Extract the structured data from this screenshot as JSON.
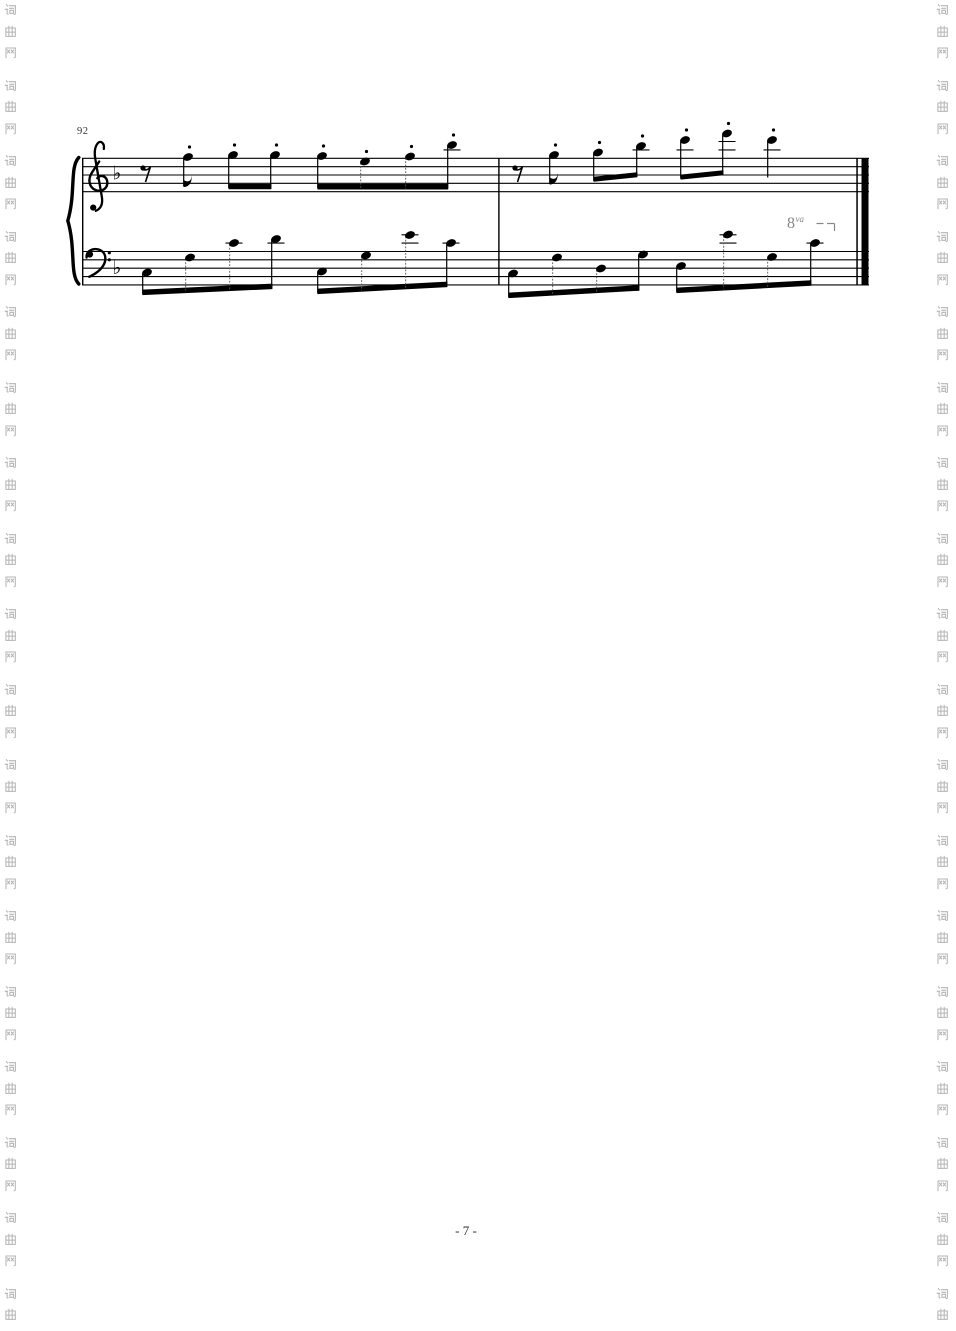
{
  "page": {
    "width": 956,
    "height": 1331,
    "background": "#ffffff",
    "page_number": "- 7 -",
    "page_number_color": "#2b2b2b"
  },
  "watermark": {
    "text": "词曲网",
    "chars": [
      "词",
      "曲",
      "网"
    ],
    "color": "#b5b5b5",
    "dash_color": "#c9c9c9",
    "columns": [
      {
        "side": "left",
        "char_x": 4,
        "line_x": 26
      },
      {
        "side": "right",
        "char_x": 936,
        "line_x": 930
      }
    ],
    "start_y": 3,
    "char_step": 21.5,
    "group_step": 75.5,
    "char_size": 13
  },
  "score": {
    "measure_number": "92",
    "measure_number_color": "#333333",
    "ink": "#000000",
    "geometry": {
      "x_start": 82,
      "x_end": 869,
      "treble_top": 158.3,
      "bass_top": 251.5,
      "gap": 8.35,
      "staff_line_count": 5,
      "system_top": 158.3,
      "system_bottom": 284.9
    },
    "brace": true,
    "clefs": [
      "treble",
      "bass"
    ],
    "key_signature": {
      "name": "1 flat (F major)",
      "glyph": "♭",
      "treble": {
        "x": 112.5,
        "baseline": 179.5
      },
      "bass": {
        "x": 112.5,
        "baseline": 274
      }
    },
    "rests": [
      {
        "type": "eighth",
        "staff": "treble",
        "x": 146,
        "y": 166
      },
      {
        "type": "eighth",
        "staff": "treble",
        "x": 518,
        "y": 166
      }
    ],
    "beams": [
      {
        "x1": 228.6,
        "y1": 184.0,
        "x2": 271.4,
        "y2": 184.0,
        "t": 5.2
      },
      {
        "x1": 317.6,
        "y1": 184.0,
        "x2": 448.2,
        "y2": 184.0,
        "t": 5.5
      },
      {
        "x1": 593.6,
        "y1": 176.8,
        "x2": 637.4,
        "y2": 172.2,
        "t": 5.0
      },
      {
        "x1": 680.6,
        "y1": 174.6,
        "x2": 723.4,
        "y2": 170.2,
        "t": 5.0
      },
      {
        "x1": 142.4,
        "y1": 289.6,
        "x2": 272.4,
        "y2": 283.6,
        "t": 5.5
      },
      {
        "x1": 317.4,
        "y1": 288.6,
        "x2": 447.4,
        "y2": 281.6,
        "t": 5.5
      },
      {
        "x1": 508.4,
        "y1": 292.6,
        "x2": 639.4,
        "y2": 285.2,
        "t": 5.5
      },
      {
        "x1": 676.4,
        "y1": 287.6,
        "x2": 811.4,
        "y2": 280.2,
        "t": 5.5
      }
    ],
    "notes": {
      "treble": [
        {
          "x": 188,
          "y": 157,
          "staccato": true,
          "flag": true,
          "stem_to": 186.5
        },
        {
          "x": 233,
          "y": 155,
          "staccato": true,
          "beam": 0
        },
        {
          "x": 275,
          "y": 155,
          "staccato": true,
          "beam": 0
        },
        {
          "x": 322,
          "y": 156,
          "staccato": true,
          "beam": 1
        },
        {
          "x": 365,
          "y": 161.5,
          "staccato": true,
          "beam": 1
        },
        {
          "x": 410,
          "y": 156.5,
          "staccato": true,
          "beam": 1
        },
        {
          "x": 452,
          "y": 145,
          "staccato": true,
          "beam": 1
        },
        {
          "x": 554,
          "y": 155,
          "staccato": true,
          "flag": true,
          "stem_to": 184
        },
        {
          "x": 598,
          "y": 152.5,
          "staccato": true,
          "beam": 2
        },
        {
          "x": 641,
          "y": 146,
          "staccato": true,
          "beam": 2
        },
        {
          "x": 685,
          "y": 140,
          "staccato": true,
          "beam": 3
        },
        {
          "x": 727,
          "y": 133.5,
          "staccato": true,
          "beam": 3
        },
        {
          "x": 772,
          "y": 140,
          "staccato": true,
          "stem_to": 177.5
        }
      ],
      "bass": [
        {
          "x": 147,
          "y": 272.5,
          "beam": 4
        },
        {
          "x": 190,
          "y": 257.5,
          "beam": 4
        },
        {
          "x": 234,
          "y": 243,
          "beam": 4
        },
        {
          "x": 276,
          "y": 239,
          "beam": 4
        },
        {
          "x": 322,
          "y": 271.5,
          "beam": 5
        },
        {
          "x": 366,
          "y": 255.5,
          "beam": 5
        },
        {
          "x": 410,
          "y": 235,
          "beam": 5
        },
        {
          "x": 451,
          "y": 243,
          "beam": 5
        },
        {
          "x": 513,
          "y": 273.5,
          "beam": 6
        },
        {
          "x": 557,
          "y": 257.5,
          "beam": 6
        },
        {
          "x": 601,
          "y": 268.5,
          "beam": 6
        },
        {
          "x": 643,
          "y": 254.5,
          "beam": 6
        },
        {
          "x": 681,
          "y": 266,
          "beam": 7
        },
        {
          "x": 728,
          "y": 234.5,
          "beam": 7
        },
        {
          "x": 772,
          "y": 257,
          "beam": 7
        },
        {
          "x": 815,
          "y": 243,
          "beam": 7
        }
      ]
    },
    "barlines": [
      {
        "x": 82,
        "w": 1.4
      },
      {
        "x": 498.2,
        "w": 1.4
      },
      {
        "x": 856.3,
        "w": 1.5
      },
      {
        "x": 861.5,
        "w": 7
      }
    ],
    "ledgers": [
      {
        "x": 452,
        "y": 149.9
      },
      {
        "x": 641,
        "y": 149.9
      },
      {
        "x": 685,
        "y": 149.9
      },
      {
        "x": 727,
        "y": 149.9
      },
      {
        "x": 727,
        "y": 141.5
      },
      {
        "x": 772,
        "y": 149.9
      },
      {
        "x": 234,
        "y": 243.1
      },
      {
        "x": 276,
        "y": 243.1
      },
      {
        "x": 410,
        "y": 243.1
      },
      {
        "x": 410,
        "y": 234.8
      },
      {
        "x": 451,
        "y": 243.1
      },
      {
        "x": 728,
        "y": 243.1
      },
      {
        "x": 728,
        "y": 234.8
      },
      {
        "x": 815,
        "y": 243.1
      }
    ],
    "octave": {
      "label": "8",
      "sup": "va",
      "x": 787,
      "baseline": 228,
      "color": "#878787",
      "bracket": {
        "segs": [
          [
            816.5,
            823.5
          ],
          [
            827,
            834.5
          ]
        ],
        "y": 223.5,
        "drop_x": 834.5,
        "drop_to": 231
      }
    }
  }
}
